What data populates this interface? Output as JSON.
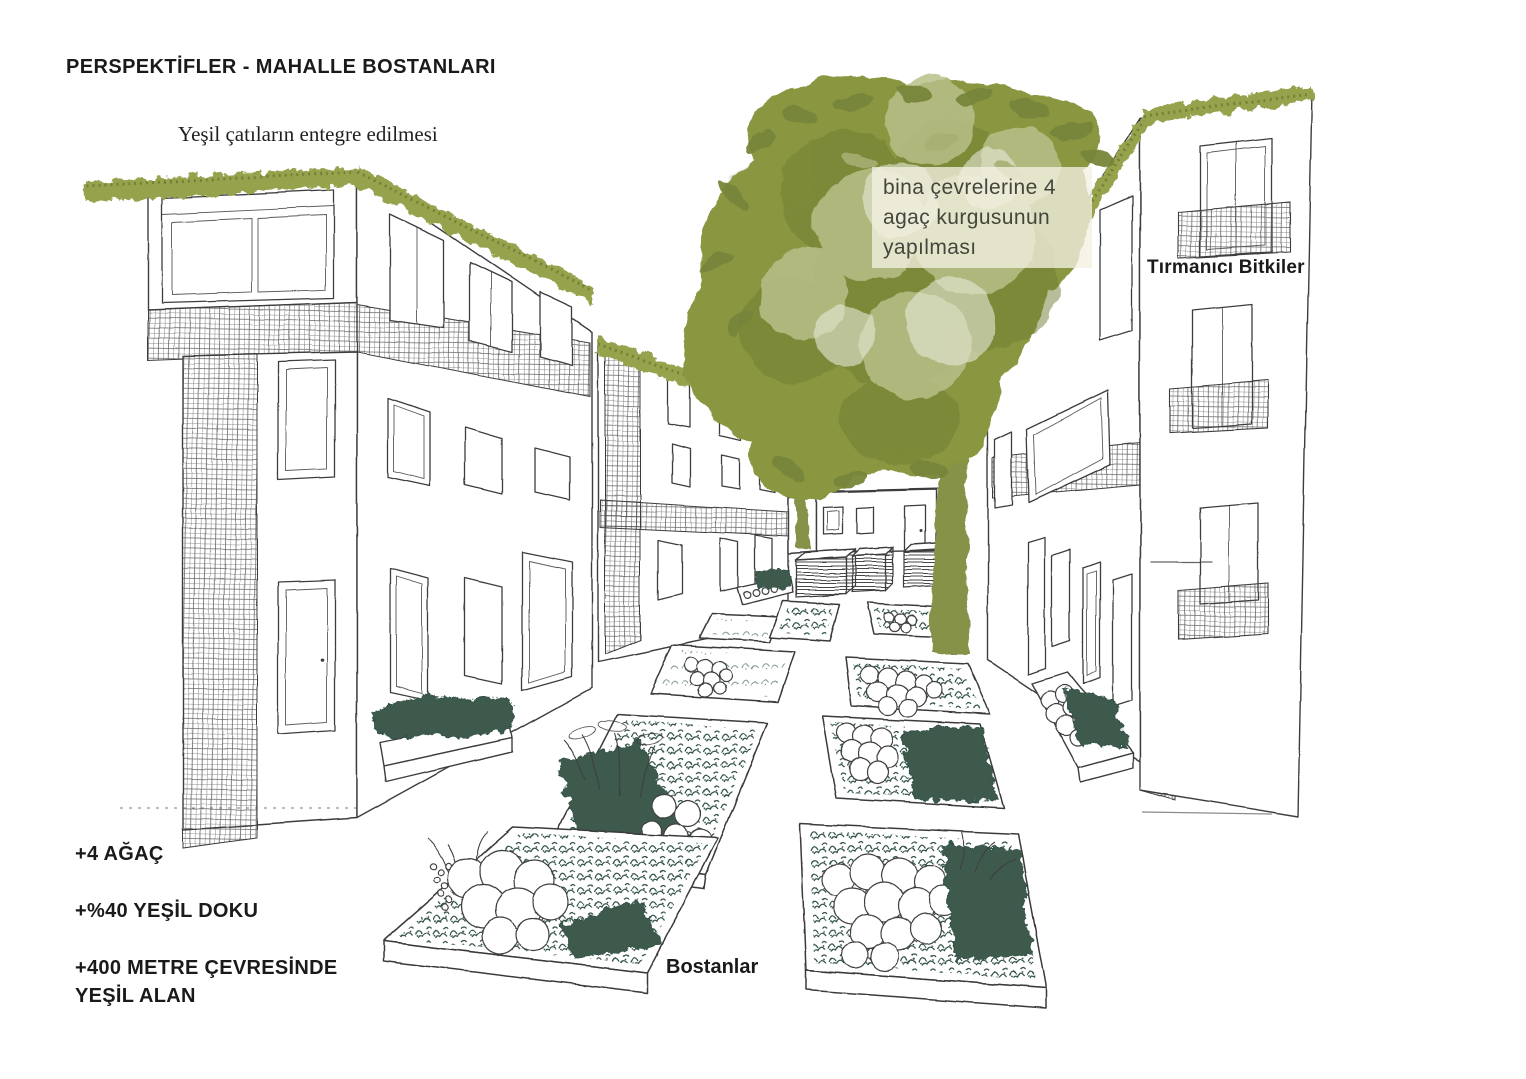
{
  "page": {
    "background": "#ffffff",
    "width_px": 1526,
    "height_px": 1079
  },
  "texts": {
    "title": "PERSPEKTİFLER - MAHALLE BOSTANLARI",
    "green_roof_note": "Yeşil çatıların entegre edilmesi",
    "tree_note": "bina çevrelerine 4\nagaç kurgusunun\nyapılması",
    "climbing_plants_label": "Tırmanıcı Bitkiler",
    "gardens_label": "Bostanlar",
    "stat_trees": "+4 AĞAÇ",
    "stat_green_texture": "+%40 YEŞİL DOKU",
    "stat_green_area": "+400 METRE ÇEVRESİNDE\nYEŞİL ALAN"
  },
  "colors": {
    "foliage": "#8a963f",
    "foliage_light": "#b8c08a",
    "foliage_dark": "#6f7d33",
    "green_roof": "#97a24d",
    "bed_plants": "#35544b",
    "sketch_line": "#3d3d3d",
    "note_box_bg": "#f1efdd",
    "text": "#1a1a1a"
  },
  "drawing": {
    "scene_objects": [
      "left-apartment-building",
      "middle-apartment-building",
      "rear-courtyard-building",
      "right-apartment-building",
      "courtyard-tree",
      "raised-garden-beds",
      "compost-crates",
      "green-roofs",
      "climbing-plant-trellis",
      "balconies"
    ]
  }
}
